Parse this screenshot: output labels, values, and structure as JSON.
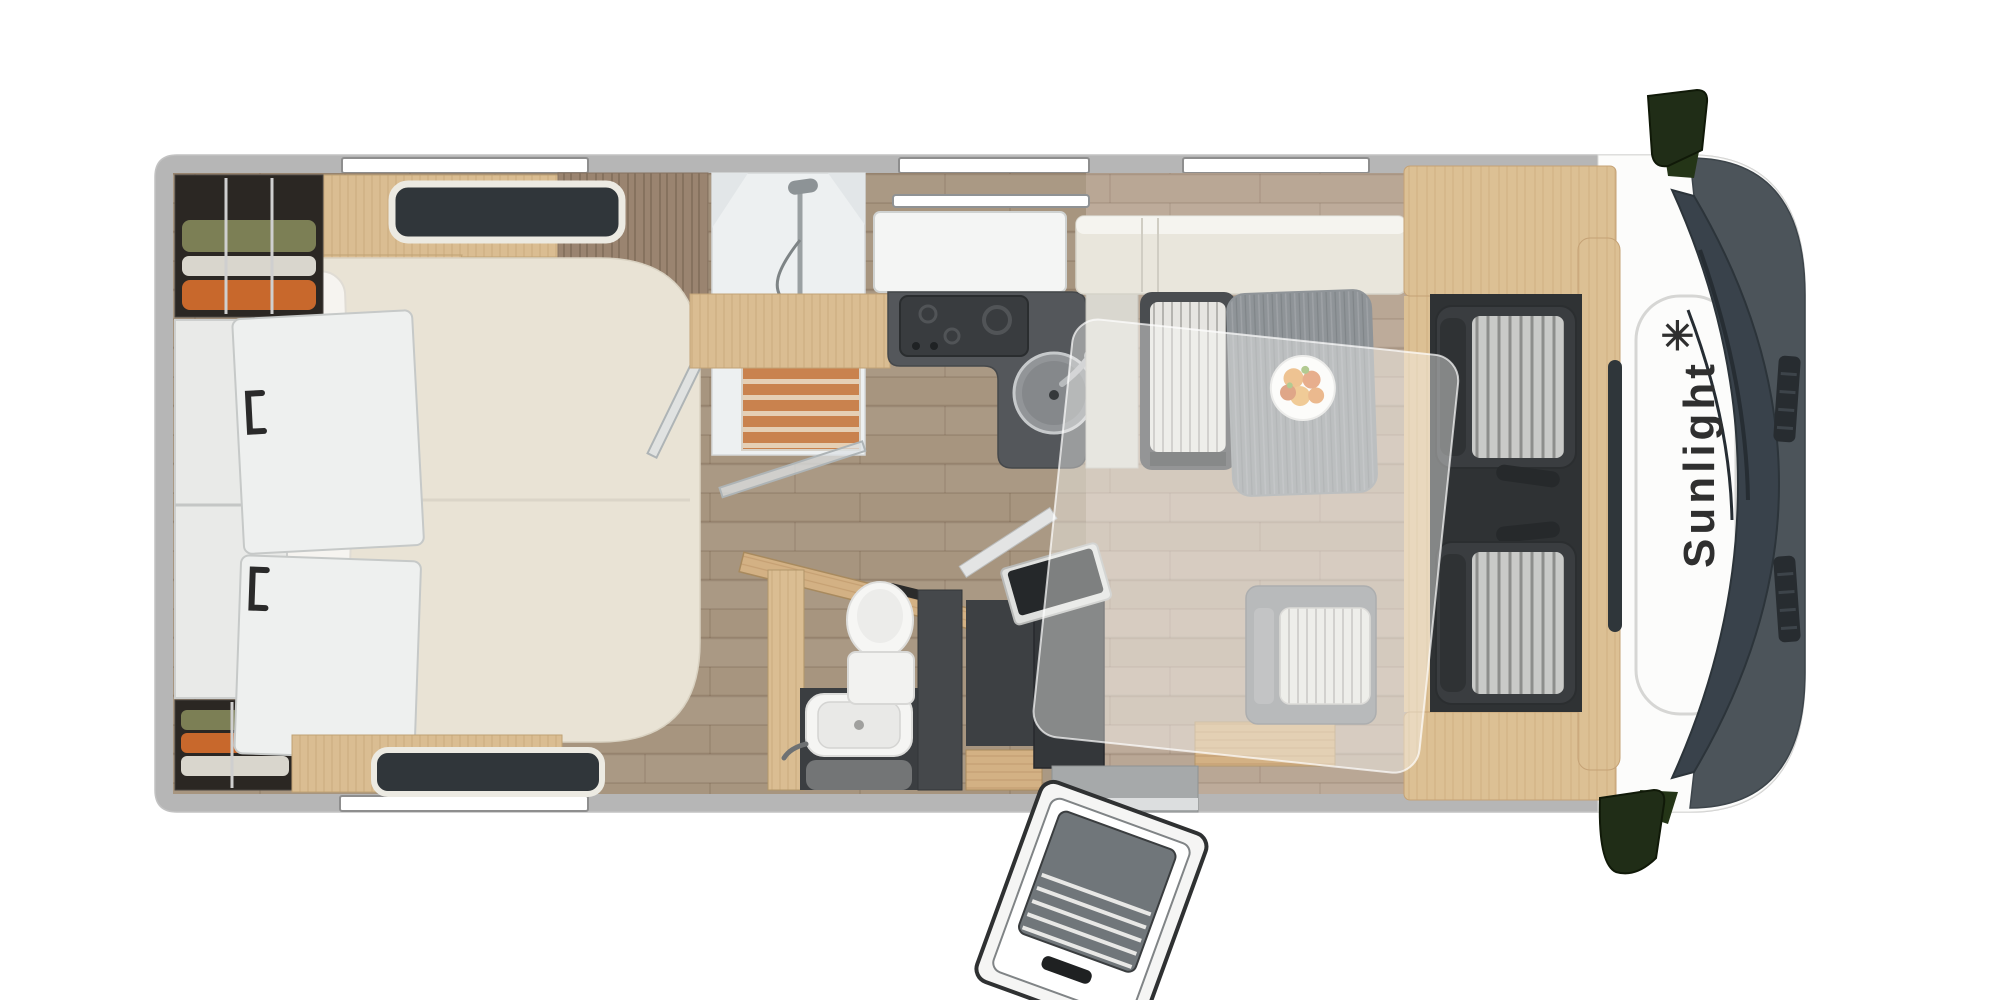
{
  "page": {
    "background": "#ffffff"
  },
  "brand": {
    "name": "Sunlight",
    "logo_star": "✳"
  },
  "colors": {
    "body_wall": "#b6b6b6",
    "cab_white": "#fcfcfb",
    "hood": "#4c545a",
    "windshield": "#39424b",
    "mirror_green": "#202d17",
    "kitchen_counter": "#54575b",
    "mattress_cream": "#e9e3d5",
    "table_gray": "#8f9498",
    "sideboard_cream": "#e9e6dc",
    "seat_dark": "#3a3d40",
    "shower_slats": "#c9824e",
    "fridge_dark": "#34373a",
    "logo_text": "#2f2f2f"
  }
}
